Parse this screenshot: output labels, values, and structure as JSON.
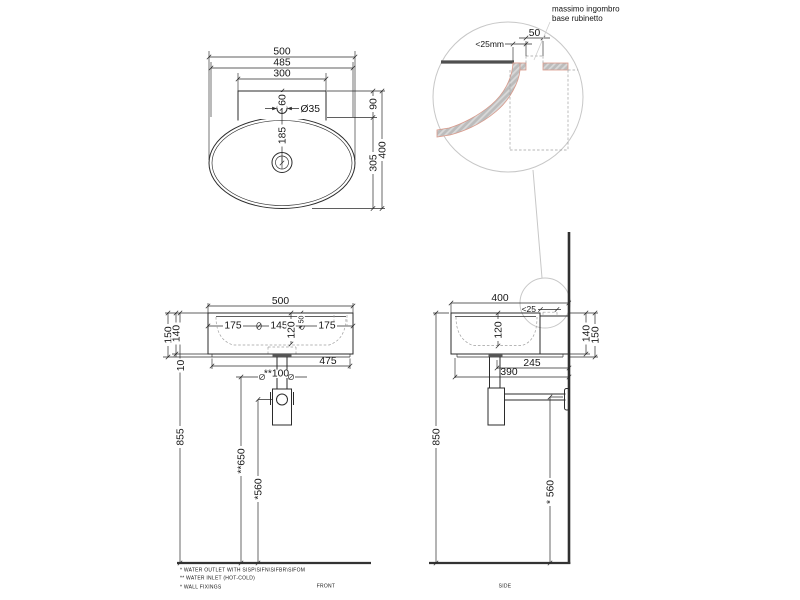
{
  "top": {
    "d500": "500",
    "d485": "485",
    "d300": "300",
    "d60": "60",
    "d35": "Ø35",
    "d185": "185",
    "d90": "90",
    "d305": "305",
    "d400": "400"
  },
  "detail": {
    "note1": "massimo ingombro",
    "note2": "base rubinetto",
    "d50": "50",
    "d25": "<25mm"
  },
  "front": {
    "d500": "500",
    "d150": "150",
    "d140": "140",
    "d10": "10",
    "d175l": "175",
    "d145": "145",
    "d120": "120",
    "d50": "50",
    "d175r": "175",
    "d475": "475",
    "d100": "**100",
    "d855": "855",
    "d650": "**650",
    "d560": "*560",
    "label": "FRONT"
  },
  "side": {
    "d400": "400",
    "d25": "<25",
    "d120": "120",
    "d140": "140",
    "d150": "150",
    "d245": "245",
    "d390": "390",
    "d850": "850",
    "d560": "* 560",
    "label": "SIDE"
  },
  "notes": {
    "n1": "*  WATER OUTLET WITH SISP\\SIFN\\SIFBR\\SIFOM",
    "n2": "** WATER INLET  (HOT-COLD)",
    "n3": "*  WALL FIXINGS"
  },
  "colors": {
    "line": "#2b2b2b",
    "light_gray": "#c7c7c7",
    "hatch_fill": "#bcbcbc",
    "section_outline": "#d9998a",
    "rim_band": "#4f4f4f"
  }
}
